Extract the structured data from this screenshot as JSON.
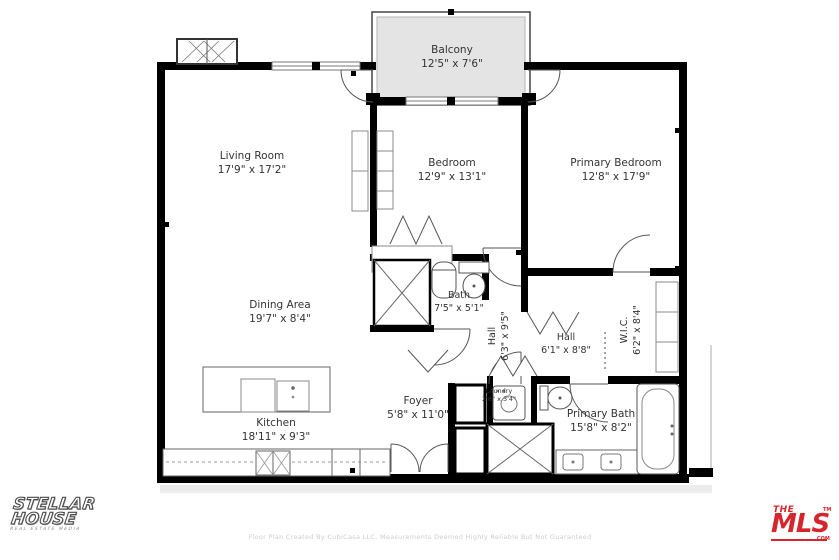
{
  "floor_plan": {
    "rooms": [
      {
        "id": "balcony",
        "name": "Balcony",
        "dims": "12'5\" x 7'6\""
      },
      {
        "id": "living-room",
        "name": "Living Room",
        "dims": "17'9\" x 17'2\""
      },
      {
        "id": "bedroom",
        "name": "Bedroom",
        "dims": "12'9\" x 13'1\""
      },
      {
        "id": "primary-bedroom",
        "name": "Primary Bedroom",
        "dims": "12'8\" x 17'9\""
      },
      {
        "id": "dining-area",
        "name": "Dining Area",
        "dims": "19'7\" x 8'4\""
      },
      {
        "id": "bath",
        "name": "Bath",
        "dims": "7'5\" x 5'1\""
      },
      {
        "id": "hall-vertical",
        "name": "Hall",
        "dims": "6'3\" x 9'5\""
      },
      {
        "id": "hall",
        "name": "Hall",
        "dims": "6'1\" x 8'8\""
      },
      {
        "id": "wic",
        "name": "W.I.C.",
        "dims": "6'2\" x 8'4\""
      },
      {
        "id": "foyer",
        "name": "Foyer",
        "dims": "5'8\" x 11'0\""
      },
      {
        "id": "laundry",
        "name": "Laundry",
        "dims": "2'8\" x 3'4\""
      },
      {
        "id": "primary-bath",
        "name": "Primary Bath",
        "dims": "15'8\" x 8'2\""
      },
      {
        "id": "kitchen",
        "name": "Kitchen",
        "dims": "18'11\" x 9'3\""
      }
    ],
    "logos": {
      "stellar_line1": "STELLAR",
      "stellar_line2": "HOUSE",
      "stellar_tagline": "REAL ESTATE MEDIA",
      "mls_the": "THE",
      "mls_name": "MLS",
      "mls_tm": "TM",
      "mls_com": ".COM"
    },
    "disclaimer": "Floor Plan Created By CubiCasa LLC. Measurements Deemed Highly Reliable But Not Guaranteed",
    "colors": {
      "wall": "#000000",
      "balcony_fill": "#e4e4e4",
      "fixture_line": "#555555",
      "label_text": "#333333",
      "mls_red": "#d6252c"
    }
  }
}
